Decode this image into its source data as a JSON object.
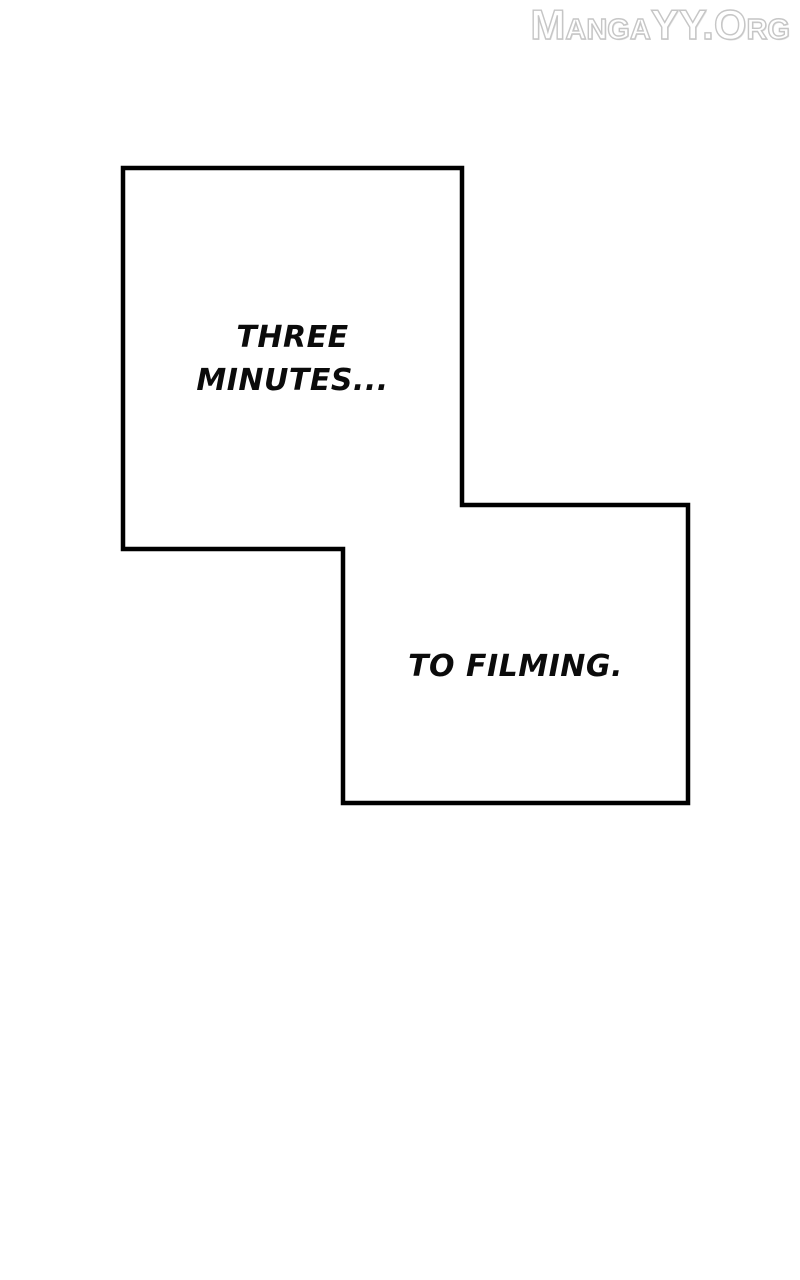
{
  "watermark": {
    "text": "MangaYY.Org",
    "text_color": "#ffffff",
    "outline_color": "#c6c6c6"
  },
  "bubbles": [
    {
      "name": "speech-panel-top-left",
      "lines": {
        "0": "THREE",
        "1": "MINUTES..."
      }
    },
    {
      "name": "speech-panel-bottom-right",
      "lines": {
        "0": "TO FILMING."
      }
    }
  ],
  "colors": {
    "background": "#ffffff",
    "panel_fill": "#ffffff",
    "panel_border": "#000000",
    "text": "#0b0b0b"
  }
}
